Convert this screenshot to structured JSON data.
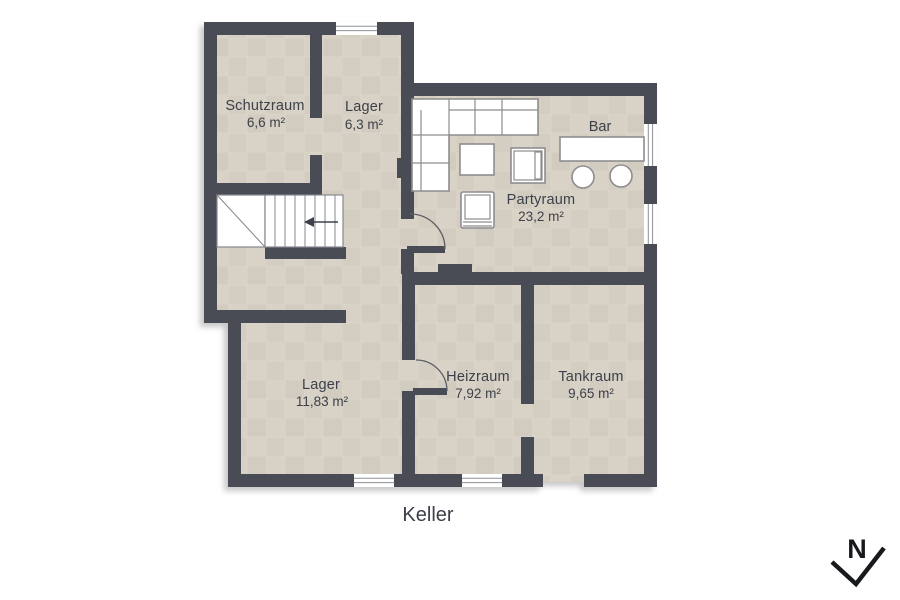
{
  "plan": {
    "title": "Keller",
    "compass_letter": "N",
    "bar_label": "Bar",
    "rooms": [
      {
        "id": "schutzraum",
        "name": "Schutzraum",
        "area": "6,6 m²"
      },
      {
        "id": "lager-klein",
        "name": "Lager",
        "area": "6,3 m²"
      },
      {
        "id": "partyraum",
        "name": "Partyraum",
        "area": "23,2 m²"
      },
      {
        "id": "lager-gross",
        "name": "Lager",
        "area": "11,83 m²"
      },
      {
        "id": "heizraum",
        "name": "Heizraum",
        "area": "7,92 m²"
      },
      {
        "id": "tankraum",
        "name": "Tankraum",
        "area": "9,65 m²"
      }
    ],
    "furniture": [
      "corner-sofa",
      "side-table",
      "tv-table",
      "armchair",
      "bar-counter",
      "bar-stool",
      "bar-stool"
    ],
    "features": [
      "staircase-with-down-arrow",
      "door-partyraum",
      "door-heizraum",
      "opening-schutzraum",
      "opening-tankraum",
      "exterior-opening-south"
    ],
    "colors": {
      "background": "#ffffff",
      "wall": "#484c55",
      "floor_base": "#d6d0c4",
      "floor_a": "#d8d2c6",
      "floor_b": "#d2ccc0",
      "floor_c": "#d4cec2",
      "floor_d": "#d9d3c7",
      "grout": "#ddd8cc",
      "text": "#3c4049",
      "window_frame": "#8d9095",
      "stair_stroke": "#85888f",
      "furniture_stroke": "#8d8d8d",
      "door_arc": "#5a5e66",
      "compass": "#17191c"
    }
  }
}
